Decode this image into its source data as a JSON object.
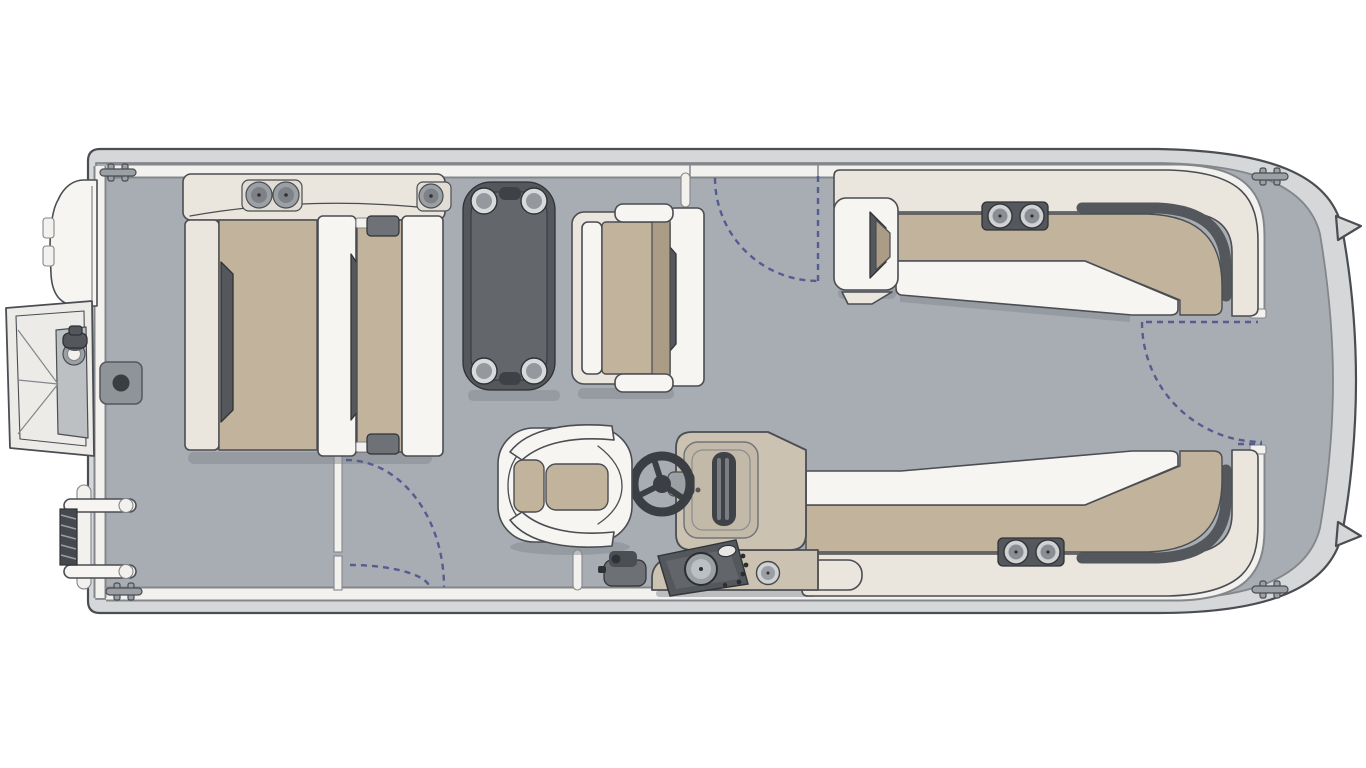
{
  "figure": {
    "type": "floorplan-diagram",
    "subject": "pontoon boat deck layout, top view",
    "orientation": "bow at right, stern swim deck and ladder at left"
  },
  "colors": {
    "bg": "#ffffff",
    "outline": "#4a4d52",
    "ink": "#2f3235",
    "line-soft": "#83868b",
    "hull-trim": "#d5d7d9",
    "deck": "#a8adb3",
    "deck-shadow": "#84898f",
    "fence": "#f3f1ee",
    "seat-cream": "#eae5dd",
    "seat-white": "#f7f5f1",
    "cushion": "#c2b39d",
    "cushion-dark": "#ab9c85",
    "dark": "#54575c",
    "mid": "#6e7277",
    "metal": "#9ba0a5",
    "console": "#ccc2b1",
    "swing": "#565c8f"
  },
  "components": [
    "pontoon-hull",
    "bow-deck",
    "perimeter-fence",
    "stern-gangway-ramp",
    "stern-navigation-light",
    "outboard-motor",
    "boarding-ladder",
    "mooring-cleats",
    "ski-tow-base",
    "port-bow-lounge-with-cupholders",
    "cocktail-table-with-cupholders",
    "companion-bench",
    "aft-upper-wraparound-lounge",
    "aft-lower-wraparound-lounge",
    "helm-console",
    "steering-wheel",
    "instrument-panel",
    "throttle-lever",
    "captains-chair",
    "gate-swing-arcs"
  ]
}
